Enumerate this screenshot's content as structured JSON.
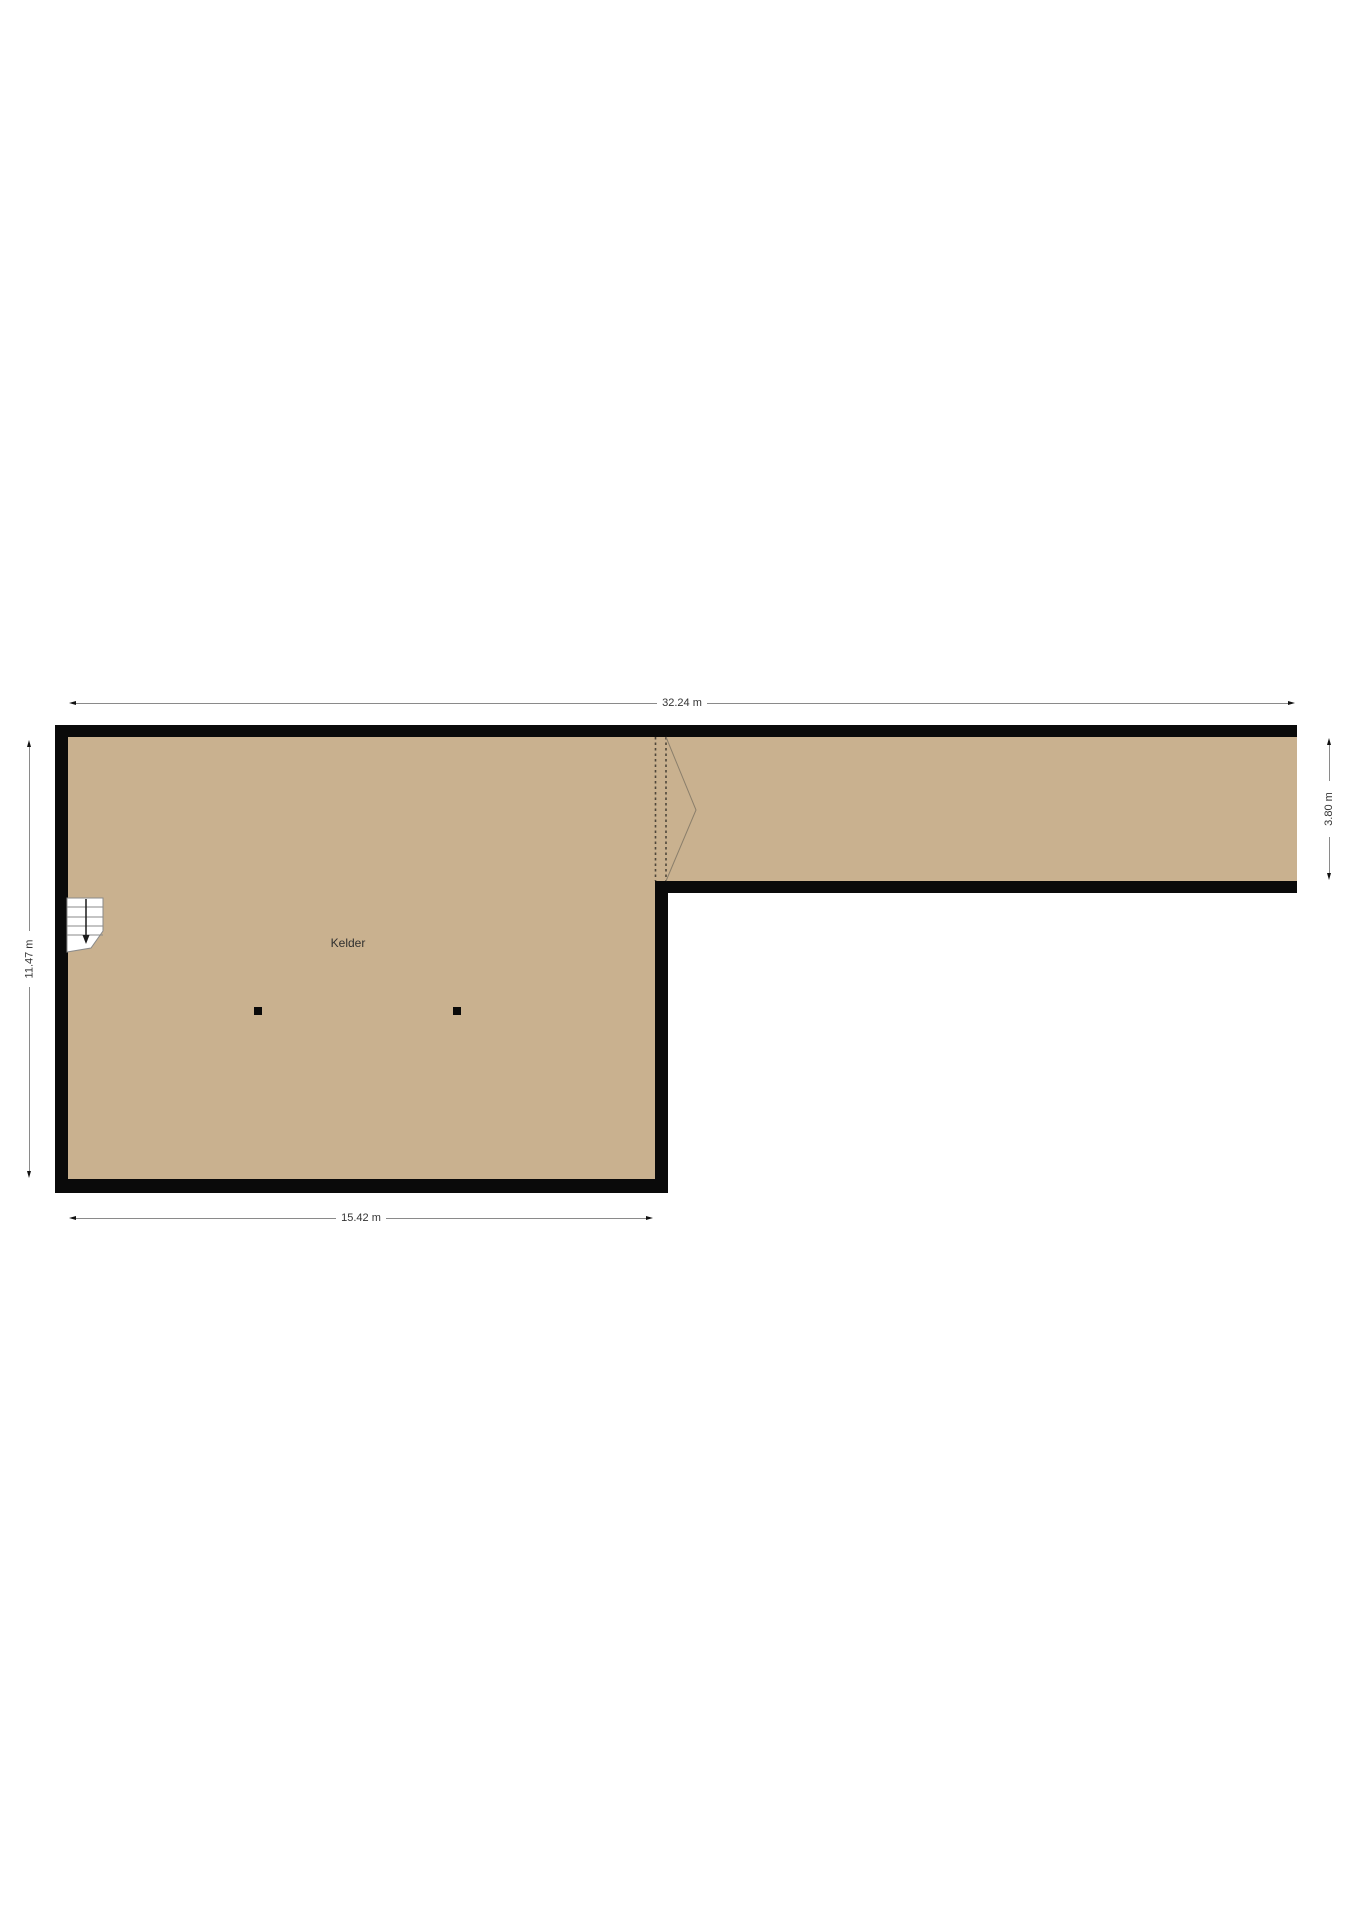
{
  "room": {
    "label": "Kelder"
  },
  "dimensions": {
    "top": {
      "label": "32.24 m",
      "orientation": "horizontal"
    },
    "bottom": {
      "label": "15.42 m",
      "orientation": "horizontal"
    },
    "left": {
      "label": "11.47 m",
      "orientation": "vertical"
    },
    "right": {
      "label": "3.80 m",
      "orientation": "vertical"
    }
  },
  "colors": {
    "background": "#ffffff",
    "floor": "#c9b18f",
    "wall": "#0a0a0a",
    "dimension_line": "#8a8a8a",
    "dimension_text": "#333333",
    "stairs_outline": "#8a8a8a",
    "opening_dashes": "#4e463a",
    "chevron": "#8b7f6b"
  },
  "icons": {
    "stairs": "staircase-with-down-arrow",
    "columns": "structural-column-marker",
    "opening": "dashed-opening-with-chevron",
    "dim_arrows": "dimension-arrowheads"
  }
}
